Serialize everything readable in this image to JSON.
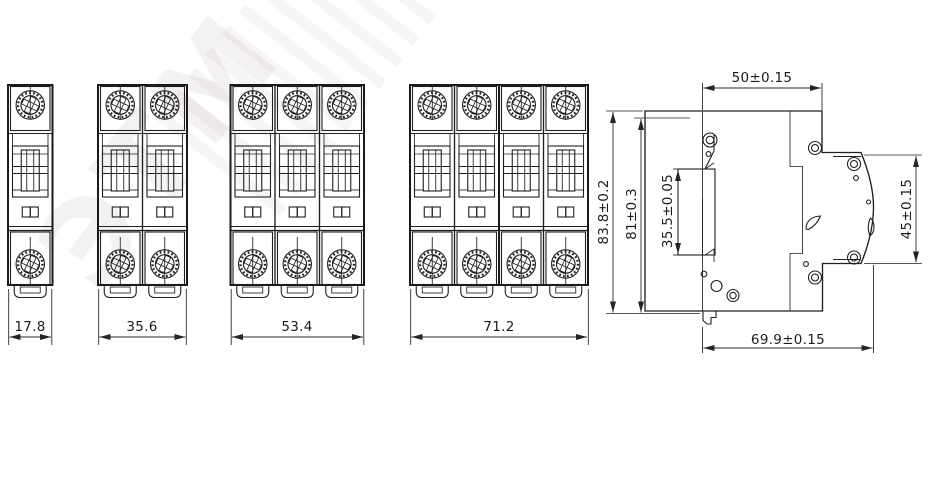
{
  "watermark": {
    "text": "ЭТМ"
  },
  "views": {
    "front": [
      {
        "id": "1-pole",
        "poles": 1,
        "width_label": "17.8"
      },
      {
        "id": "2-pole",
        "poles": 2,
        "width_label": "35.6"
      },
      {
        "id": "3-pole",
        "poles": 3,
        "width_label": "53.4"
      },
      {
        "id": "4-pole",
        "poles": 4,
        "width_label": "71.2"
      }
    ],
    "side": {
      "labels": {
        "top_width": "50±0.15",
        "overall_height": "83.8±0.2",
        "body_height": "81±0.3",
        "din_slot": "35.5±0.05",
        "front_height": "45±0.15",
        "depth": "69.9±0.15"
      }
    }
  },
  "colors": {
    "line": "#202020",
    "background": "#ffffff",
    "dim_text": "#1b1b1b"
  }
}
